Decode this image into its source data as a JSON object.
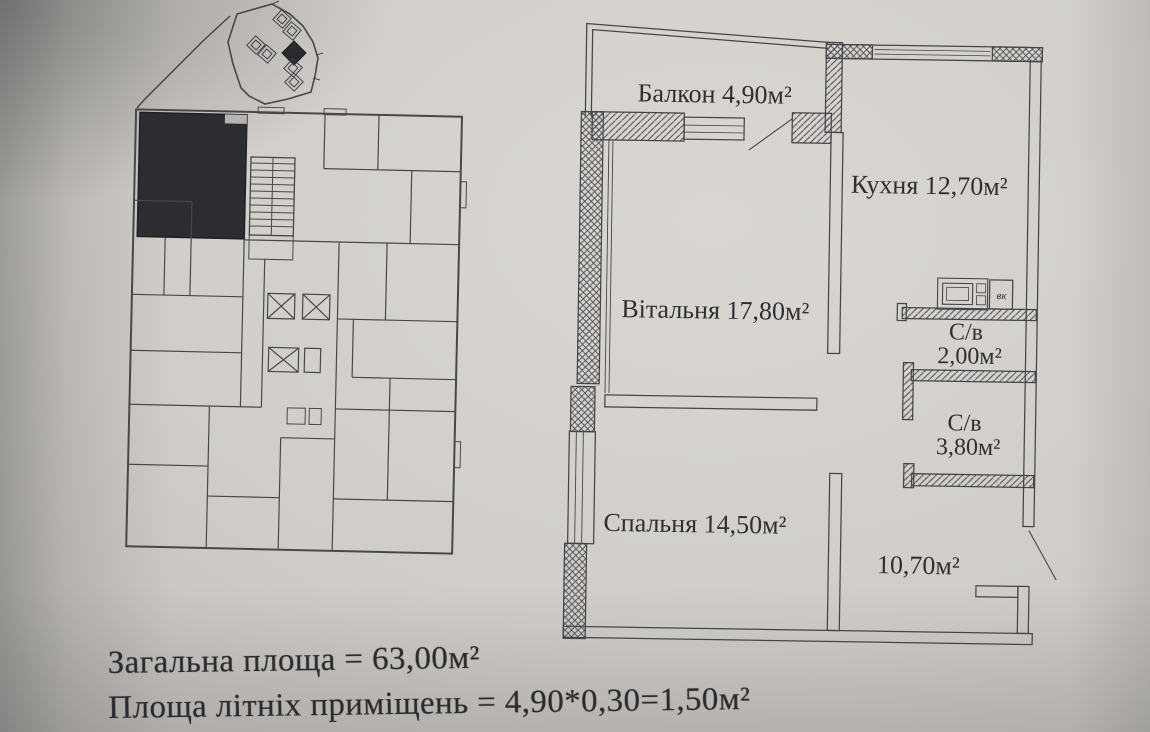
{
  "page": {
    "apartment": {
      "balcony_label": "Балкон 4,90м²",
      "kitchen_label": "Кухня 12,70м²",
      "living_label": "Вітальня 17,80м²",
      "bath_small_name": "С/в",
      "bath_small_area": "2,00м²",
      "bath_large_name": "С/в",
      "bath_large_area": "3,80м²",
      "bedroom_label": "Спальня 14,50м²",
      "hall_label": "10,70м²",
      "vent_label": "вк"
    },
    "totals": {
      "total_area": "Загальна площа = 63,00м²",
      "summer_area": "Площа літніх приміщень = 4,90*0,30=1,50м²"
    },
    "colors": {
      "paper_light": "#d8d5d0",
      "paper_dark": "#9d9b99",
      "ink": "#45444a",
      "text_ink": "#2b2a2f",
      "highlighted_unit_fill": "#2b2d30"
    }
  }
}
